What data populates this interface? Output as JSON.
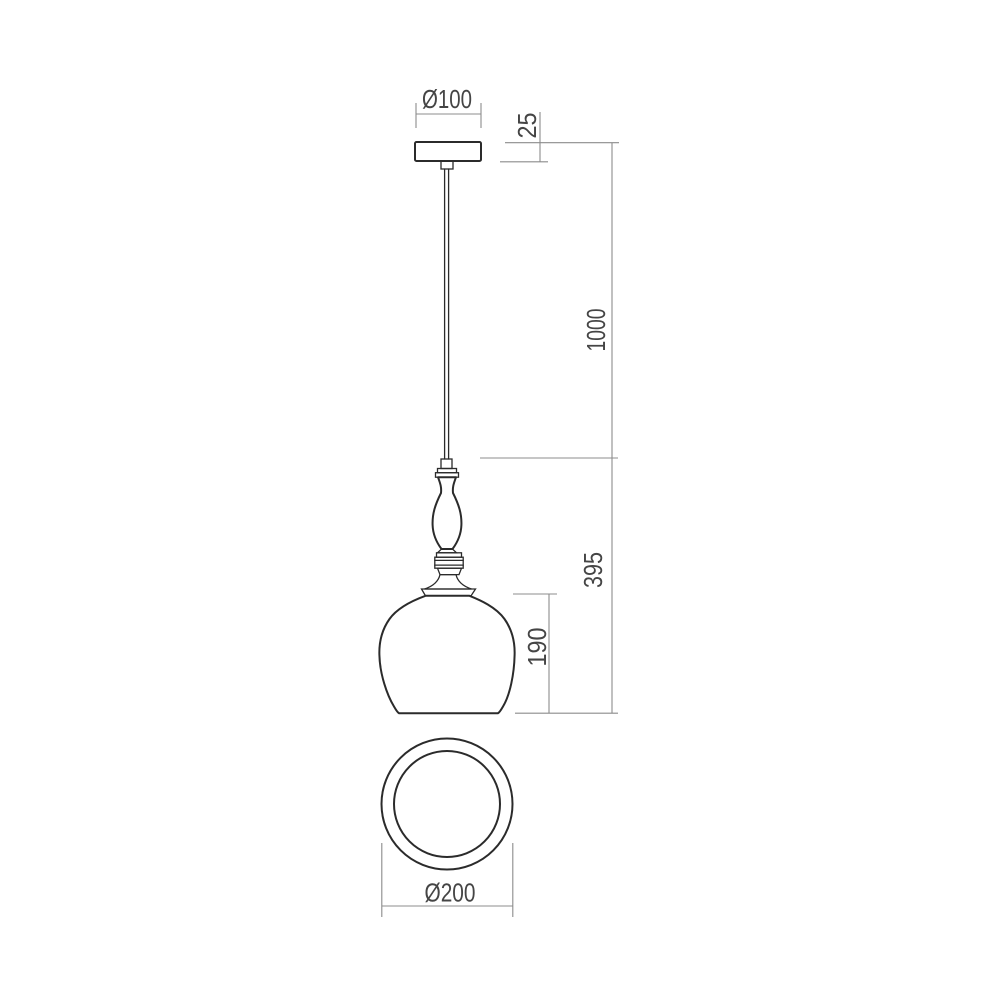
{
  "drawing": {
    "type": "pendant-lamp-technical-drawing",
    "background_color": "#ffffff",
    "object_line_color": "#2b2b2b",
    "dimension_line_color": "#8c8c8c",
    "label_color": "#454545",
    "views": {
      "side_view_parts": [
        "ceiling-canopy",
        "suspension-cable",
        "cord-grip",
        "baluster-finial",
        "ring-collar",
        "trumpet-flare",
        "bell-shade"
      ],
      "bottom_view_parts": [
        "outer-rim-circle",
        "inner-opening-circle"
      ]
    },
    "dimensions": {
      "canopy_diameter": {
        "label": "Ø100",
        "value": 100
      },
      "canopy_height": {
        "label": "25",
        "value": 25
      },
      "cable_length": {
        "label": "1000",
        "value": 1000
      },
      "fixture_height": {
        "label": "395",
        "value": 395
      },
      "shade_height": {
        "label": "190",
        "value": 190
      },
      "shade_diameter": {
        "label": "Ø200",
        "value": 200
      }
    }
  }
}
